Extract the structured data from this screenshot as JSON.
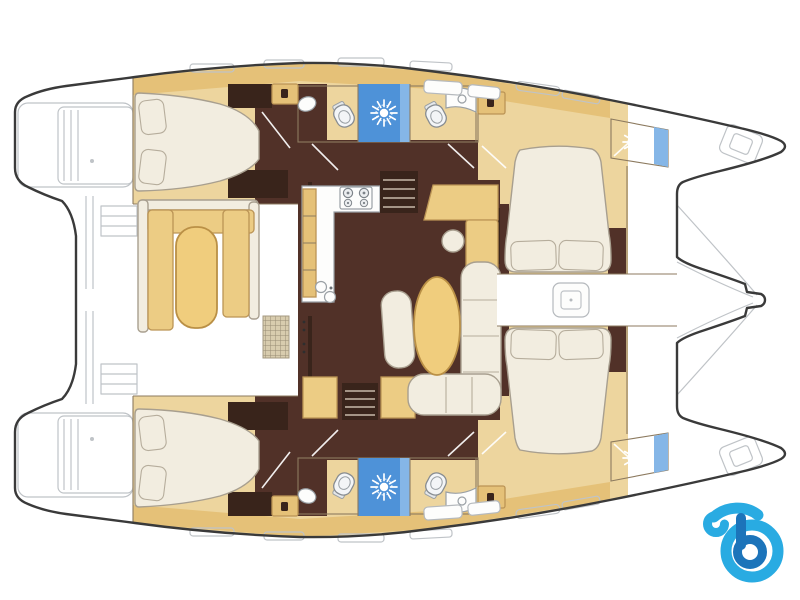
{
  "canvas": {
    "width": 800,
    "height": 600,
    "background": "#ffffff"
  },
  "palette": {
    "white": "#ffffff",
    "floor_yellow": "#edd59e",
    "cabinet_tan": "#e5c178",
    "dark_floor": "#513128",
    "wood_dark": "#39241b",
    "bath_blue": "#b9d2ec",
    "shower_blue": "#4e92d8",
    "shower_blue_light": "#85b6e7",
    "furniture_cream": "#f2ede0",
    "pillow_cream": "#e9e2d1",
    "bench_tan": "#eccc84",
    "table_tan": "#f0cd7d",
    "counter_white": "#fdfdfc",
    "grate_tan": "#d8ccae"
  },
  "logo": {
    "letter": "b",
    "light_blue": "#29abe2",
    "dark_blue": "#1c74ba"
  },
  "floorplan": {
    "view": "catamaran deck plan, top-down, bow at right",
    "double_beds": 4,
    "toilets": 4,
    "shower_sun_symbols": 4,
    "areas": [
      "aft cabin port",
      "aft cabin starboard",
      "forward cabin port",
      "forward cabin starboard",
      "bathroom port",
      "bathroom starboard",
      "forward shower port",
      "forward shower starboard",
      "galley",
      "dinette with oval table",
      "cockpit seating with table",
      "forward walkway with deck hatch",
      "trampoline",
      "stern platforms"
    ]
  }
}
